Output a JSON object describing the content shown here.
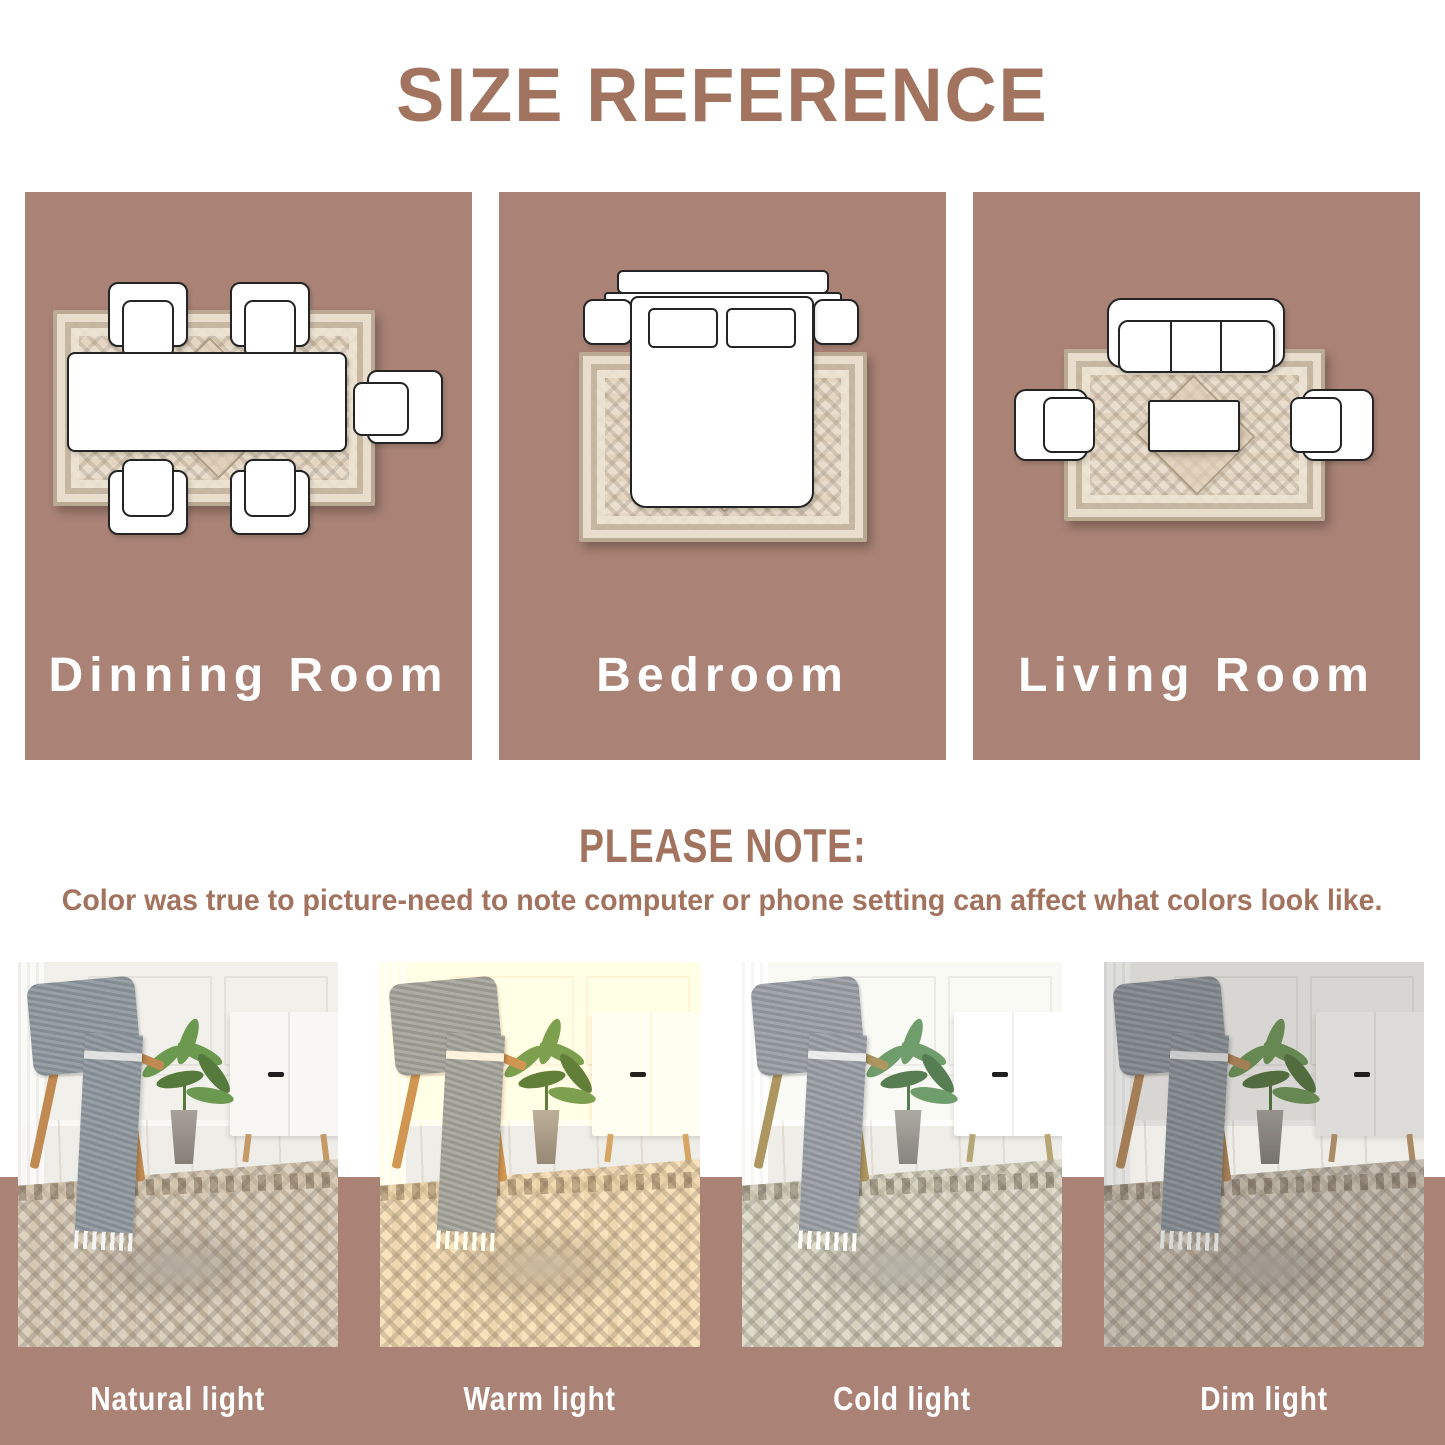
{
  "colors": {
    "accent": "#a2735f",
    "panel-bg": "#aa8376",
    "label-white": "#ffffff"
  },
  "header": {
    "title": "SIZE REFERENCE"
  },
  "size_reference": {
    "rooms": [
      {
        "label": "Dinning Room"
      },
      {
        "label": "Bedroom"
      },
      {
        "label": "Living Room"
      }
    ]
  },
  "note": {
    "heading": "PLEASE NOTE:",
    "body": "Color was true to picture-need to note computer or phone setting can affect what colors look like."
  },
  "lighting": {
    "items": [
      {
        "label": "Natural light",
        "filter": "none"
      },
      {
        "label": "Warm light",
        "filter": "sepia(0.28) saturate(1.3) brightness(1.02)"
      },
      {
        "label": "Cold light",
        "filter": "saturate(0.72) hue-rotate(14deg) brightness(1.04)"
      },
      {
        "label": "Dim light",
        "filter": "saturate(0.8) brightness(0.9) contrast(0.98)"
      }
    ]
  }
}
